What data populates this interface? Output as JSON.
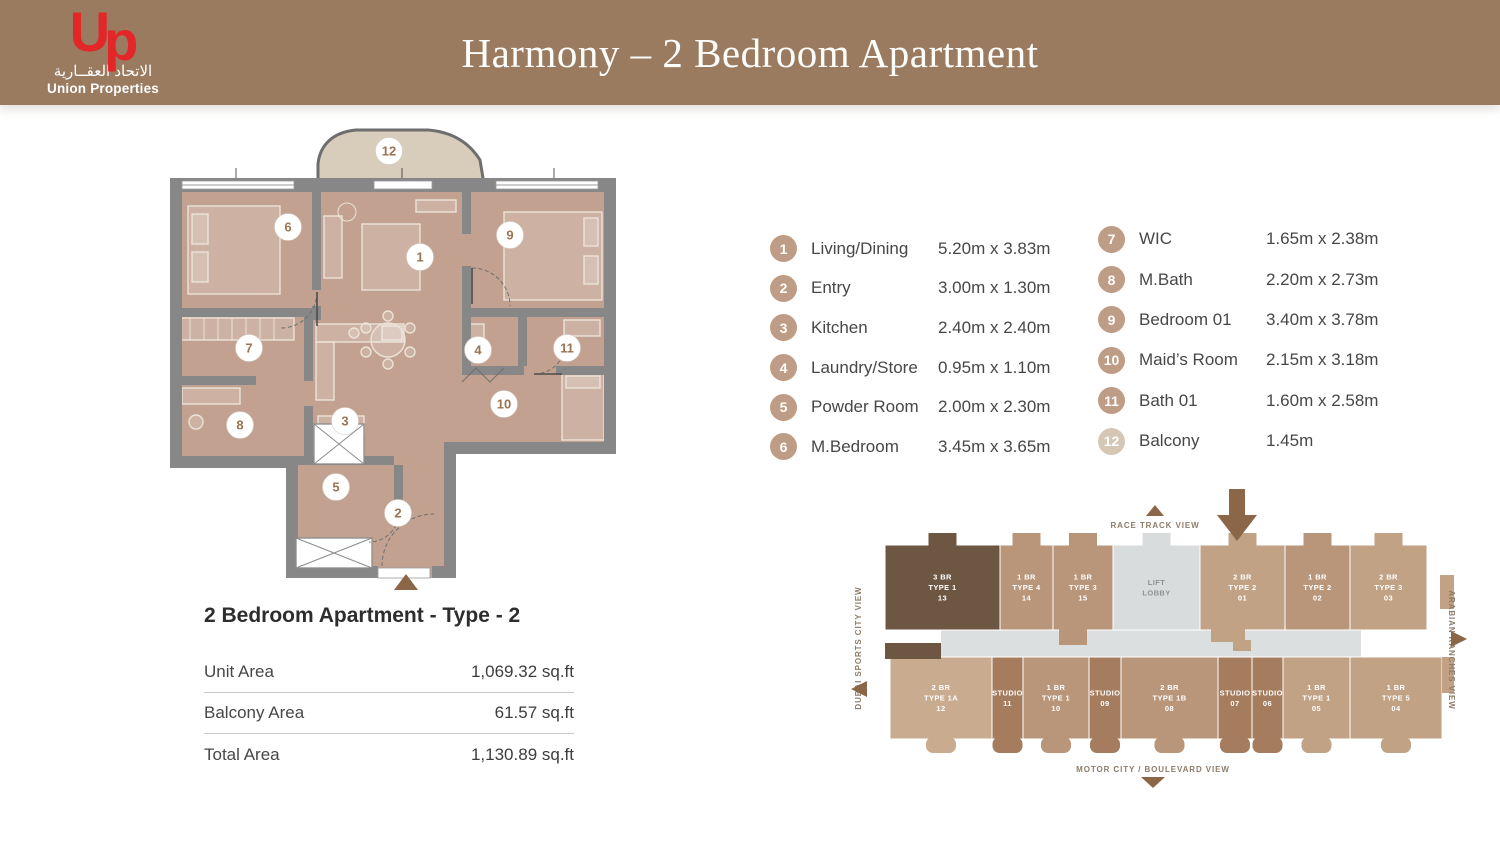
{
  "header": {
    "title": "Harmony – 2 Bedroom Apartment",
    "bg_color": "#9a7b5f",
    "logo": {
      "mark_u": "U",
      "mark_p": "p",
      "arabic": "الاتحاد العقــارية",
      "name": "Union Properties",
      "red": "#e32628"
    }
  },
  "legend": {
    "badge_color": "#bf9c85",
    "items": [
      {
        "num": "1",
        "label": "Living/Dining",
        "dims": "5.20m x 3.83m"
      },
      {
        "num": "2",
        "label": "Entry",
        "dims": "3.00m x 1.30m"
      },
      {
        "num": "3",
        "label": "Kitchen",
        "dims": "2.40m x 2.40m"
      },
      {
        "num": "4",
        "label": "Laundry/Store",
        "dims": "0.95m x 1.10m"
      },
      {
        "num": "5",
        "label": "Powder Room",
        "dims": "2.00m x 2.30m"
      },
      {
        "num": "6",
        "label": "M.Bedroom",
        "dims": "3.45m x 3.65m"
      },
      {
        "num": "7",
        "label": "WIC",
        "dims": "1.65m x 2.38m"
      },
      {
        "num": "8",
        "label": "M.Bath",
        "dims": "2.20m x 2.73m"
      },
      {
        "num": "9",
        "label": "Bedroom 01",
        "dims": "3.40m x 3.78m"
      },
      {
        "num": "10",
        "label": "Maid’s Room",
        "dims": "2.15m x 3.18m"
      },
      {
        "num": "11",
        "label": "Bath 01",
        "dims": "1.60m x 2.58m"
      },
      {
        "num": "12",
        "label": "Balcony",
        "dims": "1.45m",
        "light": true
      }
    ]
  },
  "unit_info": {
    "title": "2 Bedroom Apartment - Type - 2",
    "rows": [
      {
        "label": "Unit Area",
        "value": "1,069.32 sq.ft"
      },
      {
        "label": "Balcony Area",
        "value": "61.57 sq.ft"
      },
      {
        "label": "Total Area",
        "value": "1,130.89 sq.ft"
      }
    ]
  },
  "floor_plan": {
    "wall_color": "#878787",
    "floor_color": "#c2a190",
    "balcony_color": "#d8ccba",
    "markers": [
      {
        "num": "1",
        "x": 254,
        "y": 137
      },
      {
        "num": "2",
        "x": 232,
        "y": 393
      },
      {
        "num": "3",
        "x": 179,
        "y": 301
      },
      {
        "num": "4",
        "x": 312,
        "y": 230
      },
      {
        "num": "5",
        "x": 170,
        "y": 367
      },
      {
        "num": "6",
        "x": 122,
        "y": 107
      },
      {
        "num": "7",
        "x": 83,
        "y": 228
      },
      {
        "num": "8",
        "x": 74,
        "y": 305
      },
      {
        "num": "9",
        "x": 344,
        "y": 115
      },
      {
        "num": "10",
        "x": 338,
        "y": 284
      },
      {
        "num": "11",
        "x": 401,
        "y": 228
      },
      {
        "num": "12",
        "x": 223,
        "y": 31
      }
    ]
  },
  "key_plan": {
    "views": {
      "top": "RACE TRACK VIEW",
      "bottom": "MOTOR CITY / BOULEVARD VIEW",
      "left": "DUBAI SPORTS CITY VIEW",
      "right": "ARABIAN RANCHES VIEW"
    },
    "tones": {
      "dark": "#6e5742",
      "tan1": "#b9967a",
      "tan2": "#c2a284",
      "tan3": "#c9ab90",
      "studio": "#a67c5e",
      "lobby": "#d9dcdd"
    },
    "top_row": [
      {
        "lines": [
          "3 BR",
          "TYPE 1",
          "13"
        ],
        "tone": "dark"
      },
      {
        "lines": [
          "1 BR",
          "TYPE 4",
          "14"
        ],
        "tone": "tan1"
      },
      {
        "lines": [
          "1 BR",
          "TYPE 3",
          "15"
        ],
        "tone": "tan1"
      },
      {
        "lines": [
          "LIFT",
          "LOBBY"
        ],
        "tone": "lobby"
      },
      {
        "lines": [
          "2 BR",
          "TYPE 2",
          "01"
        ],
        "tone": "tan2"
      },
      {
        "lines": [
          "1 BR",
          "TYPE 2",
          "02"
        ],
        "tone": "tan1"
      },
      {
        "lines": [
          "2 BR",
          "TYPE 3",
          "03"
        ],
        "tone": "tan2"
      }
    ],
    "bottom_row": [
      {
        "lines": [
          "2 BR",
          "TYPE 1A",
          "12"
        ],
        "tone": "tan3"
      },
      {
        "lines": [
          "STUDIO",
          "11"
        ],
        "tone": "studio"
      },
      {
        "lines": [
          "1 BR",
          "TYPE 1",
          "10"
        ],
        "tone": "tan1"
      },
      {
        "lines": [
          "STUDIO",
          "09"
        ],
        "tone": "studio"
      },
      {
        "lines": [
          "2 BR",
          "TYPE 1B",
          "08"
        ],
        "tone": "tan1"
      },
      {
        "lines": [
          "STUDIO",
          "07"
        ],
        "tone": "studio"
      },
      {
        "lines": [
          "STUDIO",
          "06"
        ],
        "tone": "studio"
      },
      {
        "lines": [
          "1 BR",
          "TYPE 1",
          "05"
        ],
        "tone": "tan2"
      },
      {
        "lines": [
          "1 BR",
          "TYPE 5",
          "04"
        ],
        "tone": "tan2"
      }
    ]
  }
}
